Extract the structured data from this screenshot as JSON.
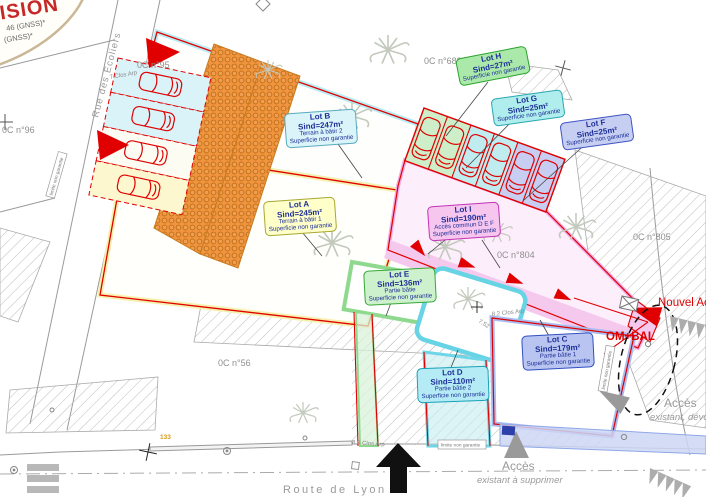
{
  "stamp": {
    "title_fragment": "ISION",
    "gnss_line1": "46 (GNSS)*",
    "gnss_line2": "(GNSS)*"
  },
  "parcel_numbers": {
    "p95": "0C n°95",
    "p96": "0C n°96",
    "p688": "0C n°688",
    "p804": "0C n°804",
    "p805": "0C n°805",
    "p56": "0C n°56"
  },
  "streets": {
    "rue_des_ecoliers": "Rue des Ecoliers",
    "route_de_lyon": "Route  de  Lyon",
    "clos_arp_7": "7 Clos Arp",
    "clos_arp_86": "8.6 Clos Arp",
    "clos_arp_82": "8.2 Clos Arp"
  },
  "dimensions": {
    "d1": "7.52",
    "n133": "133"
  },
  "lots": [
    {
      "title": "Lot A",
      "area": "Sind=245m²",
      "desc": "Terrain à bâtir 1",
      "note": "Superficie non garantie"
    },
    {
      "title": "Lot B",
      "area": "Sind=247m²",
      "desc": "Terrain à bâtir 2",
      "note": "Superficie non garantie"
    },
    {
      "title": "Lot C",
      "area": "Sind=179m²",
      "desc": "Partie bâtie 1",
      "note": "Superficie non garantie"
    },
    {
      "title": "Lot D",
      "area": "Sind=110m²",
      "desc": "Partie bâtie 2",
      "note": "Superficie non garantie"
    },
    {
      "title": "Lot E",
      "area": "Sind=136m²",
      "desc": "Partie bâtie",
      "note": "Superficie non garantie"
    },
    {
      "title": "Lot F",
      "area": "Sind=25m²",
      "desc": "",
      "note": "Superficie non garantie"
    },
    {
      "title": "Lot G",
      "area": "Sind=25m²",
      "desc": "",
      "note": "Superficie non garantie"
    },
    {
      "title": "Lot H",
      "area": "Sind=27m²",
      "desc": "",
      "note": "Superficie non garantie"
    },
    {
      "title": "Lot I",
      "area": "Sind=190m²",
      "desc": "Accès commun D E F",
      "note": "Superficie non garantie"
    }
  ],
  "annotations": {
    "nouvel_acces": "Nouvel Ac",
    "om_bal": "OM+BAL",
    "acces_devoye_1": "Accès",
    "acces_devoye_2": "existant, dévoyé",
    "acces_supprimer_1": "Accès",
    "acces_supprimer_2": "existant à supprimer",
    "limite_non_garantie": "limite non garantie"
  },
  "colors": {
    "boundary_red": "#e10000",
    "corridor_pink": "#f5c9ee",
    "building_orange": "#f09440",
    "lot_text_blue": "#1d2f97",
    "annotation_gray": "#9a9a9a"
  }
}
